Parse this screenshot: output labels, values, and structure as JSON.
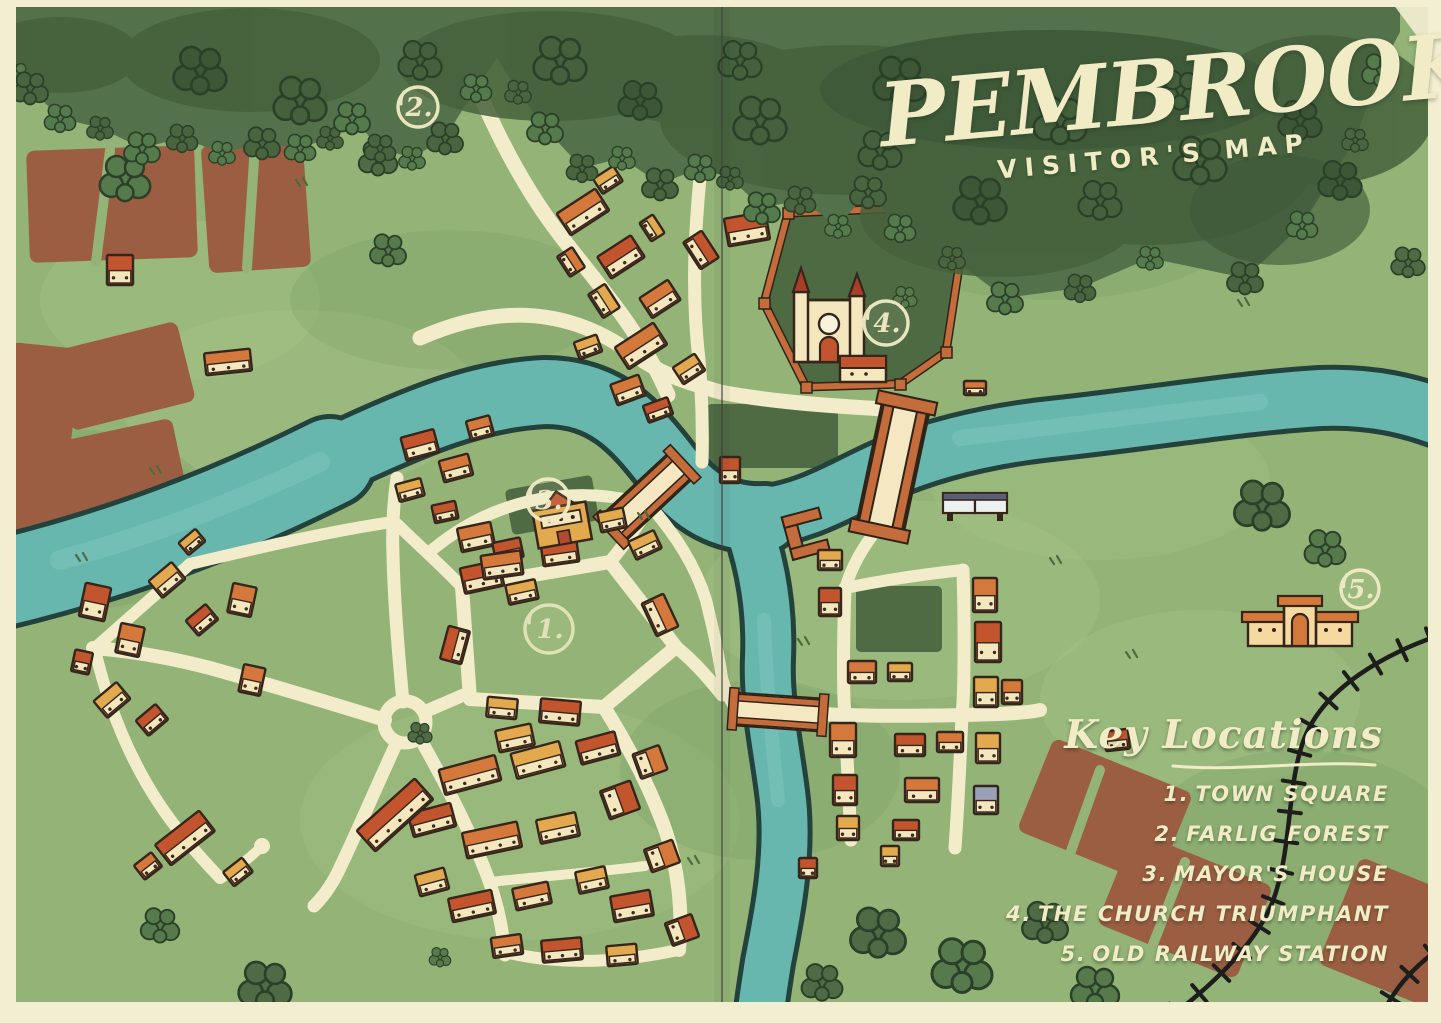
{
  "map": {
    "title": "PEMBROOK",
    "subtitle": "VISITOR'S MAP"
  },
  "legend": {
    "title": "Key Locations",
    "items": [
      {
        "num": "1.",
        "label": "TOWN SQUARE"
      },
      {
        "num": "2.",
        "label": "FARLIG FOREST"
      },
      {
        "num": "3.",
        "label": "MAYOR'S HOUSE"
      },
      {
        "num": "4.",
        "label": "THE CHURCH TRIUMPHANT"
      },
      {
        "num": "5.",
        "label": "OLD RAILWAY STATION"
      }
    ]
  },
  "markers": [
    {
      "label": "1.",
      "name": "town-square",
      "x": 549,
      "y": 629,
      "r": 24
    },
    {
      "label": "2.",
      "name": "farlig-forest",
      "x": 418,
      "y": 107,
      "r": 20
    },
    {
      "label": "3.",
      "name": "mayors-house",
      "x": 548,
      "y": 500,
      "r": 21
    },
    {
      "label": "4.",
      "name": "church-triumphant",
      "x": 886,
      "y": 323,
      "r": 22
    },
    {
      "label": "5.",
      "name": "old-railway-station",
      "x": 1360,
      "y": 589,
      "r": 19
    }
  ],
  "colors": {
    "paper": "#f3eed2",
    "grass": "#93b377",
    "forest": "#53714a",
    "forest_dark": "#46613c",
    "river": "#68b7ae",
    "river_outline": "#24423c",
    "road": "#f2ecca",
    "field": "#9b5e42",
    "cream": "#f1ecc6",
    "roof_red": "#c2552e",
    "roof_orange": "#d4783c",
    "roof_gold": "#e2a94f",
    "roof_grey": "#9aa0b5",
    "park_green": "#4f6b44",
    "wall_orange": "#c46c3b",
    "railway": "#1d1d1b",
    "building_wall": "#f5e7bd",
    "outline": "#35261c"
  }
}
